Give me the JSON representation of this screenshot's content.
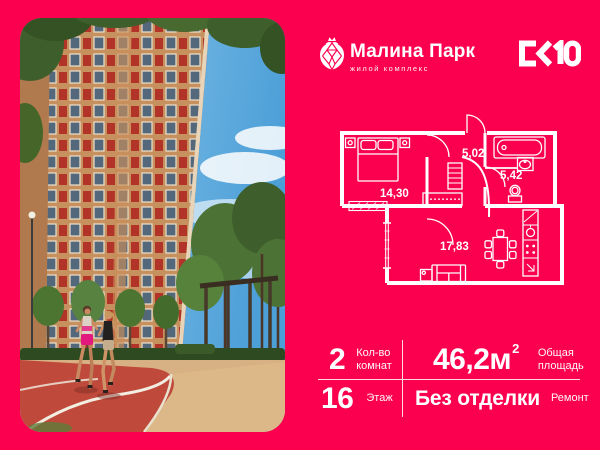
{
  "palette": {
    "background": "#FA004F",
    "foreground": "#FFFFFF",
    "plan_lines": "#FFFFFF",
    "track_red": "#BF4A3C",
    "sky_blue": "#5AA9DC",
    "facade_tan": "#C6915F",
    "balcony_red": "#B23428",
    "foliage_green": "#44632E"
  },
  "header": {
    "brand_logo_icon": "raspberry-crown-icon",
    "brand_name": "Малина Парк",
    "brand_subtitle": "жилой комплекс",
    "developer_logo": "СК10"
  },
  "floor_plan": {
    "bedroom_area": "14,30",
    "hall_area": "5,02",
    "bathroom_area": "5,42",
    "living_area": "17,83"
  },
  "stats": {
    "rooms": {
      "value": "2",
      "label1": "Кол-во",
      "label2": "комнат"
    },
    "area": {
      "value": "46,2м",
      "sup": "2",
      "label1": "Общая",
      "label2": "площадь"
    },
    "floor": {
      "value": "16",
      "label1": "Этаж"
    },
    "finish": {
      "value": "Без отделки",
      "label1": "Ремонт"
    }
  }
}
